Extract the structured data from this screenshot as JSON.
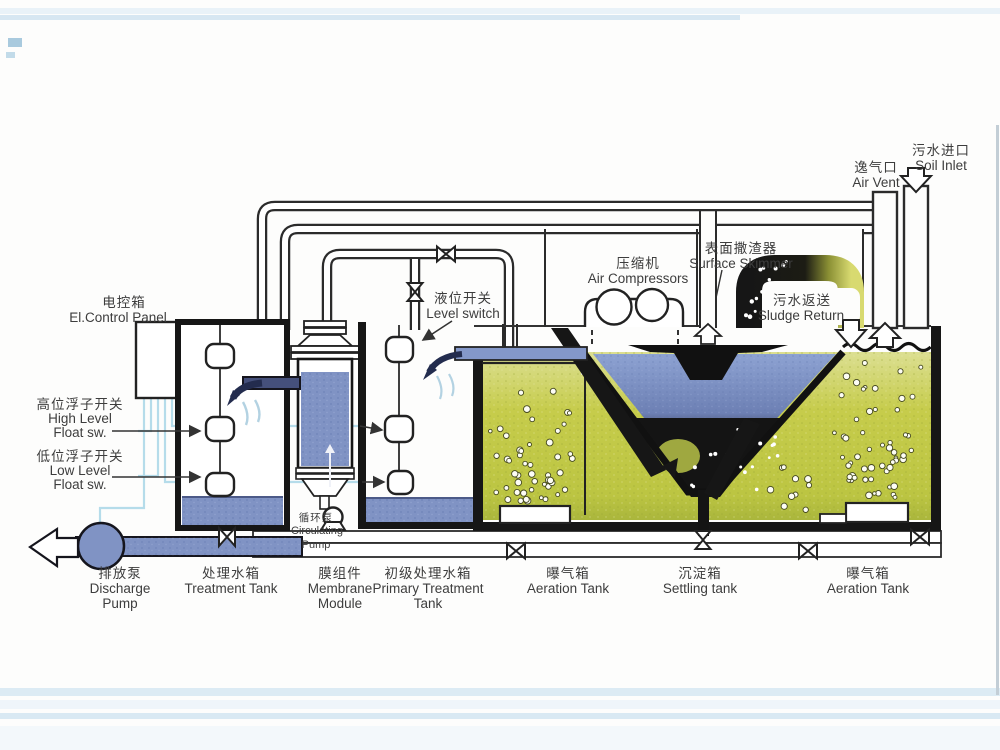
{
  "diagram_title": "Membrane wastewater treatment system schematic",
  "labels": {
    "control_panel": {
      "zh": "电控箱",
      "en": "El.Control Panel"
    },
    "high_float": {
      "zh": "高位浮子开关",
      "en1": "High Level",
      "en2": "Float sw."
    },
    "low_float": {
      "zh": "低位浮子开关",
      "en1": "Low Level",
      "en2": "Float sw."
    },
    "discharge_pump": {
      "zh": "排放泵",
      "en1": "Discharge",
      "en2": "Pump"
    },
    "treatment_tank": {
      "zh": "处理水箱",
      "en": "Treatment Tank"
    },
    "membrane_module": {
      "zh": "膜组件",
      "en1": "Membrane",
      "en2": "Module"
    },
    "circulating_pump": {
      "zh": "循环泵",
      "en1": "Circulating",
      "en2": "Pump"
    },
    "primary_tank": {
      "zh": "初级处理水箱",
      "en1": "Primary Treatment",
      "en2": "Tank"
    },
    "level_switch": {
      "zh": "液位开关",
      "en": "Level switch"
    },
    "air_compressors": {
      "zh": "压缩机",
      "en": "Air Compressors"
    },
    "surface_skimmer": {
      "zh": "表面撒渣器",
      "en": "Surface Skimmer"
    },
    "sludge_return": {
      "zh": "污水返送",
      "en": "Sludge Return"
    },
    "air_vent": {
      "zh": "逸气口",
      "en": "Air Vent"
    },
    "soil_inlet": {
      "zh": "污水进口",
      "en": "Soil Inlet"
    },
    "aeration_tank_left": {
      "zh": "曝气箱",
      "en": "Aeration Tank"
    },
    "settling_tank": {
      "zh": "沉淀箱",
      "en": "Settling tank"
    },
    "aeration_tank_right": {
      "zh": "曝气箱",
      "en": "Aeration Tank"
    }
  },
  "colors": {
    "water_blue": "#8093c4",
    "aeration_green": "#c6cc4b",
    "sludge_dark": "#141414",
    "wire_blue": "#b5dcea",
    "outline": "#2b2b2b"
  }
}
